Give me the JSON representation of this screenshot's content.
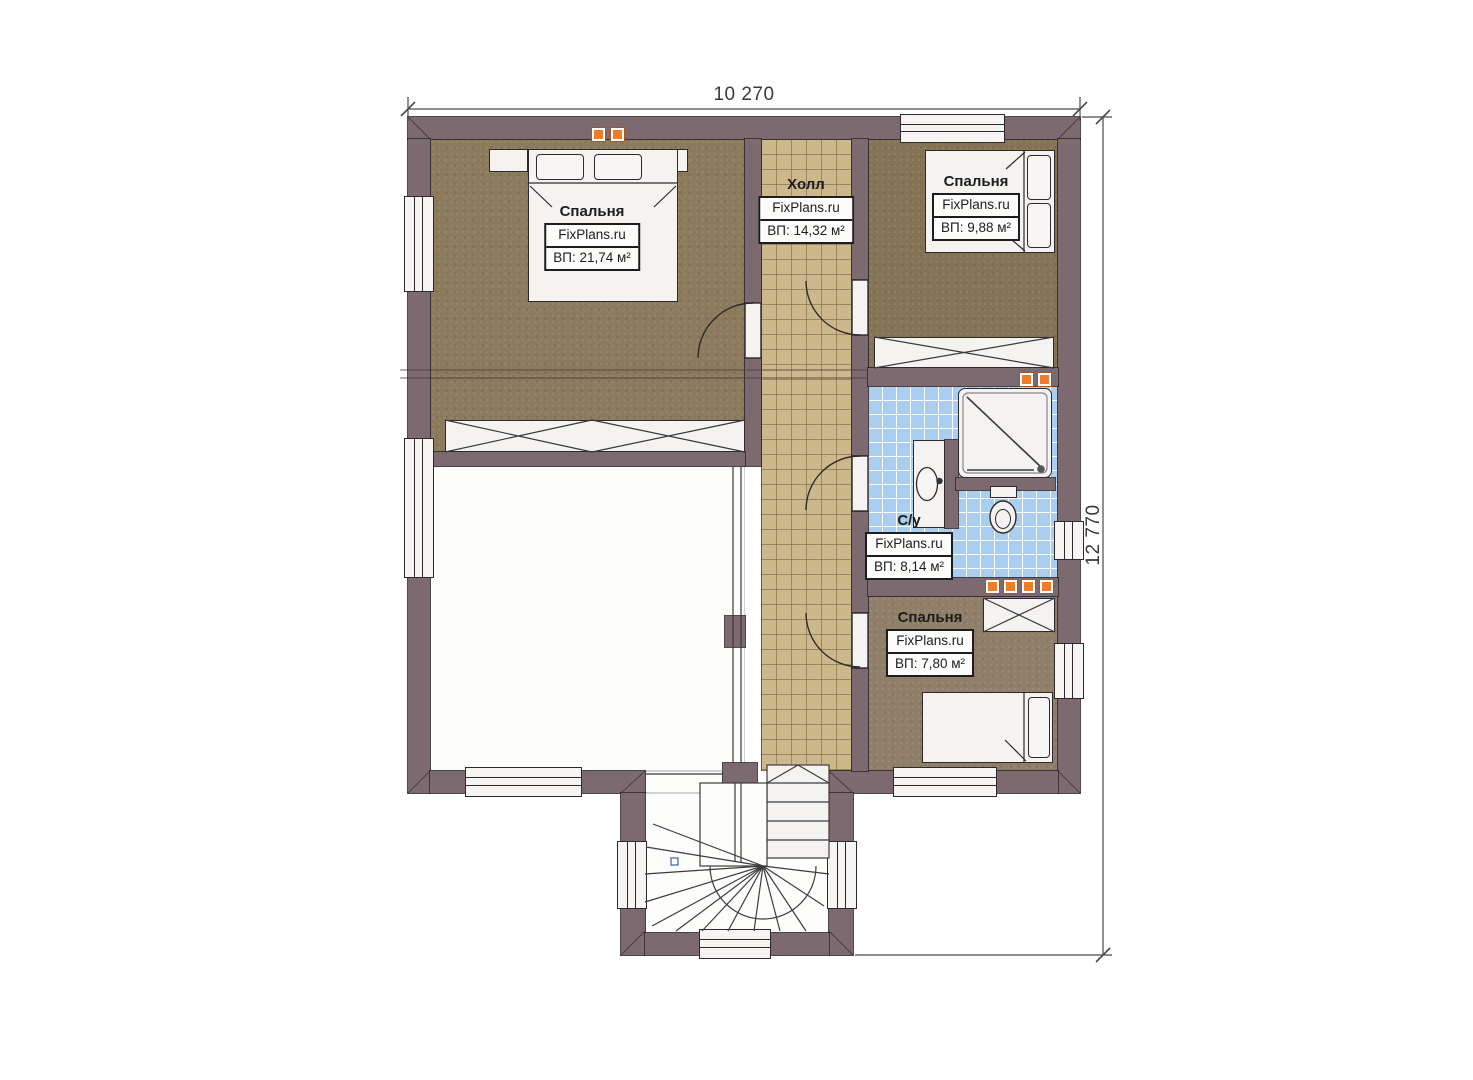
{
  "plan": {
    "brand": "FixPlans.ru",
    "dimensions": {
      "top": "10 270",
      "right": "12 770"
    },
    "rooms": [
      {
        "id": "bedroom-1",
        "name": "Спальня",
        "area": "ВП: 21,74 м²"
      },
      {
        "id": "hall",
        "name": "Холл",
        "area": "ВП: 14,32 м²"
      },
      {
        "id": "bedroom-2",
        "name": "Спальня",
        "area": "ВП: 9,88 м²"
      },
      {
        "id": "bathroom",
        "name": "С/у",
        "area": "ВП: 8,14 м²"
      },
      {
        "id": "bedroom-3",
        "name": "Спальня",
        "area": "ВП: 7,80 м²"
      }
    ],
    "colors": {
      "wall": "#7d6a71",
      "carpet_bedroom1": "#8b7a5c",
      "carpet_bedroom2": "#857356",
      "carpet_bedroom3": "#8f7e68",
      "hall_tile": "#cdb88c",
      "bath_tile": "#a9ceef",
      "fixture_white": "#f4f3f1",
      "marker_orange": "#ee7c2b",
      "outline": "#2e2a2c"
    }
  }
}
